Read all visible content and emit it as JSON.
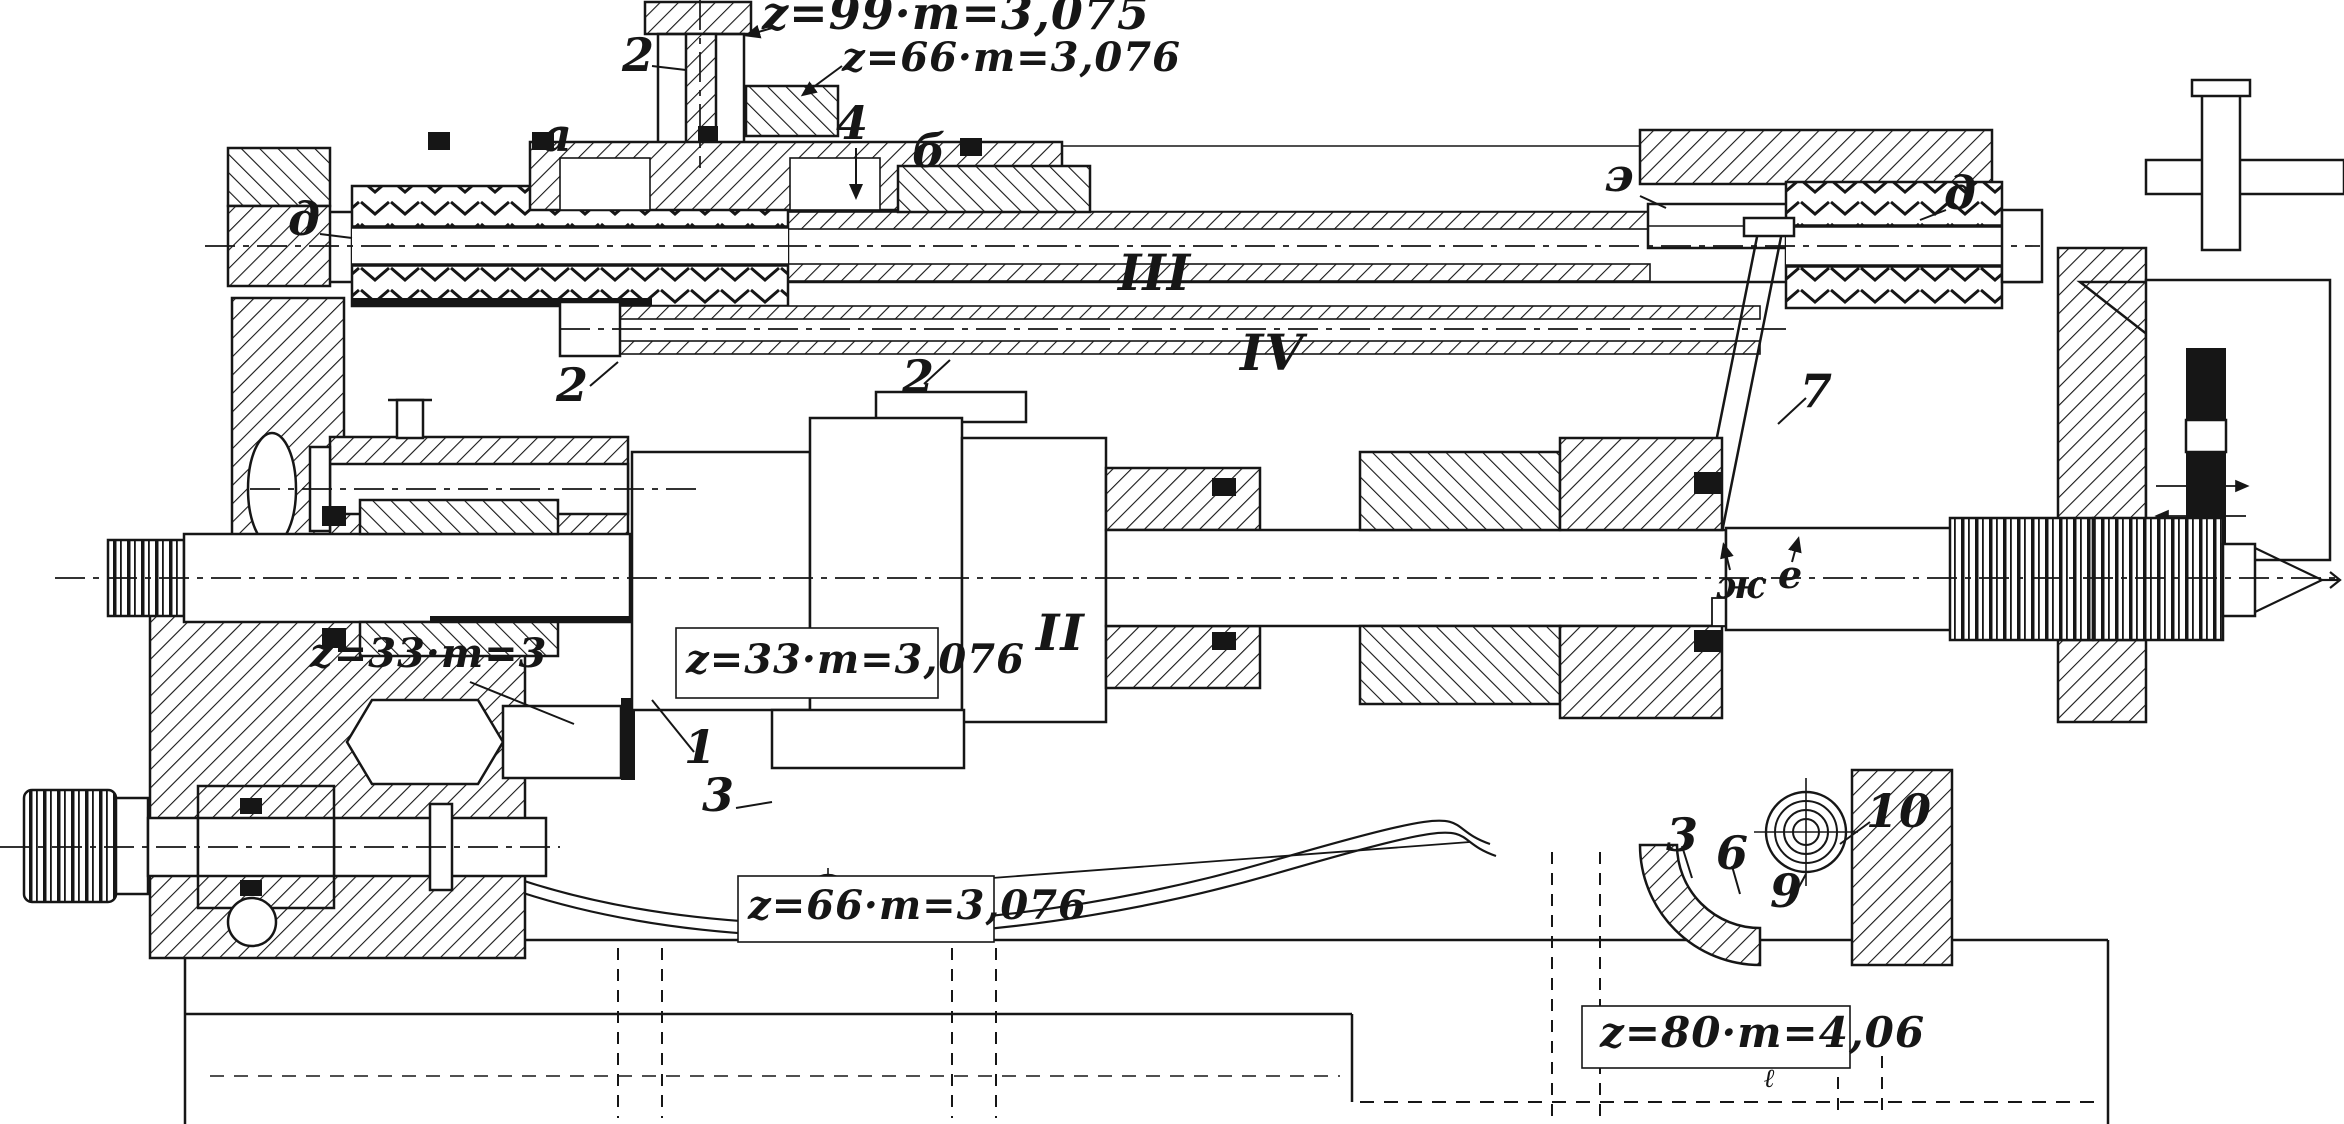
{
  "drawing": {
    "paper_color": "#ffffff",
    "ink_color": "#161616",
    "gear_annotations": {
      "z99": "z=99·m=3,075",
      "z66_upper": "z=66·m=3,076",
      "z33_plain": "z=33·m=3",
      "z33_alt": "z=33·m=3,076",
      "z66_lower": "z=66·m=3,076",
      "z80": "z=80·m=4,06"
    },
    "shaft_numerals": {
      "ii": "II",
      "iii": "III",
      "iv": "IV"
    },
    "part_numbers": {
      "n1": "1",
      "n2a": "2",
      "n2b": "2",
      "n2c": "2",
      "n3a": "3",
      "n3b": "3",
      "n4": "4",
      "n6": "6",
      "n7": "7",
      "n9": "9",
      "n10": "10"
    },
    "letter_labels": {
      "a": "а",
      "b": "б",
      "d_left": "д",
      "d_right": "д",
      "e_reversed": "э",
      "zh": "ж",
      "e": "е",
      "ell": "ℓ"
    }
  }
}
